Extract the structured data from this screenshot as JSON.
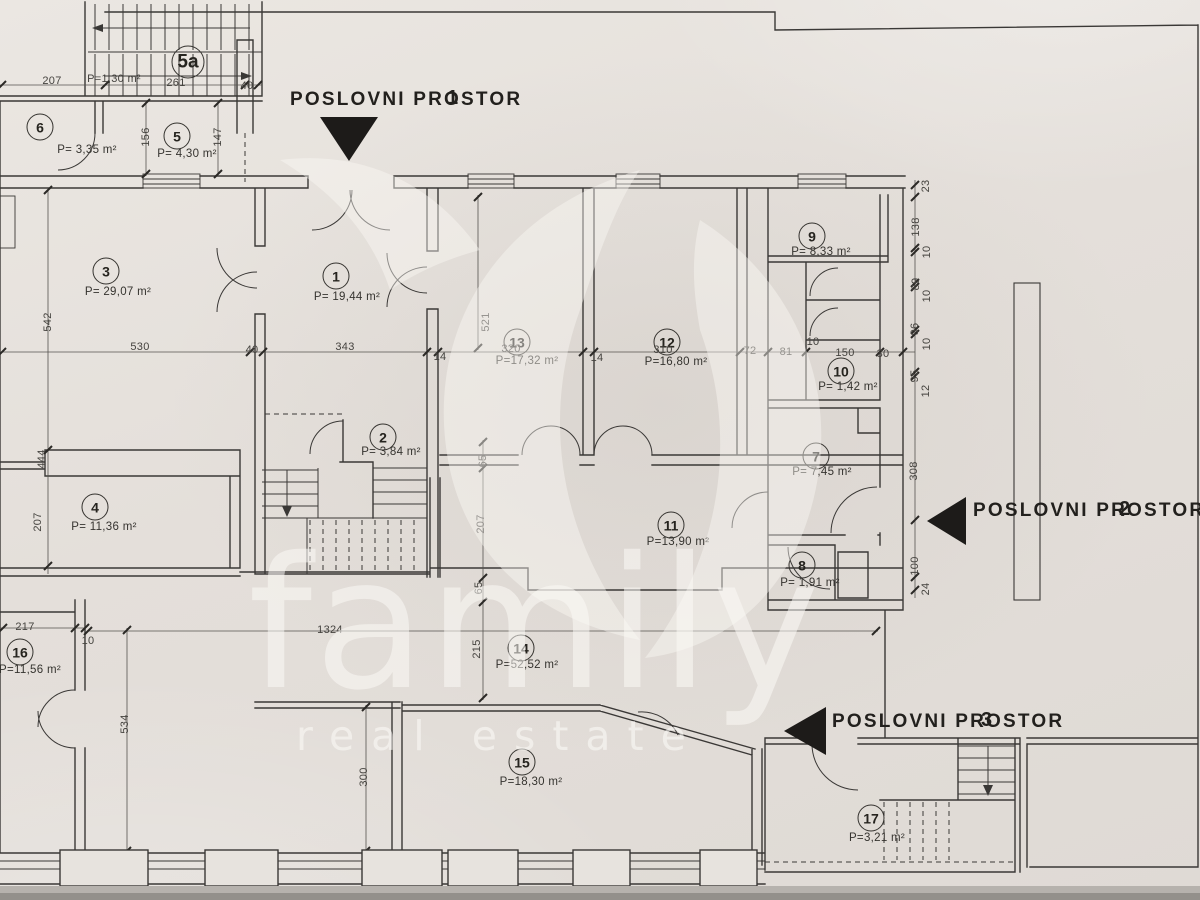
{
  "colors": {
    "line": "#3a3836",
    "dim_line": "#55534f",
    "arrow_fill": "#1d1b19",
    "paper": "#e7e3de"
  },
  "watermark": {
    "brand": "family",
    "tagline": "real estate"
  },
  "annotations": [
    {
      "text": "POSLOVNI PROSTOR",
      "digit": "1",
      "x": 290,
      "y": 89,
      "digit_dx": 157,
      "arrow": "down"
    },
    {
      "text": "POSLOVNI PROSTOR",
      "digit": "2",
      "x": 973,
      "y": 500,
      "digit_dx": 146,
      "arrow": "left"
    },
    {
      "text": "POSLOVNI PROSTOR",
      "digit": "3",
      "x": 832,
      "y": 711,
      "digit_dx": 149,
      "arrow": "left"
    }
  ],
  "rooms": [
    {
      "num": "5a",
      "area": "",
      "cx": 188,
      "cy": 62,
      "big": true
    },
    {
      "num": "6",
      "area": "P= 3,35 m²",
      "cx": 40,
      "cy": 127,
      "ax": 87,
      "ay": 150
    },
    {
      "num": "5",
      "area": "P= 4,30 m²",
      "cx": 177,
      "cy": 136,
      "ax": 187,
      "ay": 154
    },
    {
      "num": "3",
      "area": "P= 29,07 m²",
      "cx": 106,
      "cy": 271,
      "ax": 118,
      "ay": 292
    },
    {
      "num": "1",
      "area": "P= 19,44 m²",
      "cx": 336,
      "cy": 276,
      "ax": 347,
      "ay": 297
    },
    {
      "num": "13",
      "area": "P=17,32 m²",
      "cx": 517,
      "cy": 342,
      "ax": 527,
      "ay": 361
    },
    {
      "num": "12",
      "area": "P=16,80 m²",
      "cx": 667,
      "cy": 342,
      "ax": 676,
      "ay": 362
    },
    {
      "num": "9",
      "area": "P= 8,33 m²",
      "cx": 812,
      "cy": 236,
      "ax": 821,
      "ay": 252
    },
    {
      "num": "10",
      "area": "P= 1,42 m²",
      "cx": 841,
      "cy": 371,
      "ax": 848,
      "ay": 387
    },
    {
      "num": "7",
      "area": "P= 7,45 m²",
      "cx": 816,
      "cy": 456,
      "ax": 822,
      "ay": 472
    },
    {
      "num": "8",
      "area": "P= 1,91 m²",
      "cx": 802,
      "cy": 565,
      "ax": 810,
      "ay": 583
    },
    {
      "num": "2",
      "area": "P= 3,84 m²",
      "cx": 383,
      "cy": 437,
      "ax": 391,
      "ay": 452
    },
    {
      "num": "4",
      "area": "P= 11,36 m²",
      "cx": 95,
      "cy": 507,
      "ax": 104,
      "ay": 527
    },
    {
      "num": "11",
      "area": "P=13,90 m²",
      "cx": 671,
      "cy": 525,
      "ax": 678,
      "ay": 542
    },
    {
      "num": "16",
      "area": "P=11,56 m²",
      "cx": 20,
      "cy": 652,
      "ax": 30,
      "ay": 670
    },
    {
      "num": "14",
      "area": "P=52,52 m²",
      "cx": 521,
      "cy": 648,
      "ax": 527,
      "ay": 665
    },
    {
      "num": "15",
      "area": "P=18,30 m²",
      "cx": 522,
      "cy": 762,
      "ax": 531,
      "ay": 782
    },
    {
      "num": "17",
      "area": "P=3,21 m²",
      "cx": 871,
      "cy": 818,
      "ax": 877,
      "ay": 838
    }
  ],
  "dimensions": [
    {
      "t": "207",
      "x": 52,
      "y": 81
    },
    {
      "t": "261",
      "x": 176,
      "y": 83
    },
    {
      "t": "40",
      "x": 247,
      "y": 86
    },
    {
      "t": "P=1,30 m²",
      "x": 114,
      "y": 79
    },
    {
      "t": "156",
      "x": 146,
      "y": 137,
      "r": 1
    },
    {
      "t": "147",
      "x": 218,
      "y": 137,
      "r": 1
    },
    {
      "t": "542",
      "x": 48,
      "y": 322,
      "r": 1
    },
    {
      "t": "530",
      "x": 140,
      "y": 347
    },
    {
      "t": "40",
      "x": 252,
      "y": 350
    },
    {
      "t": "343",
      "x": 345,
      "y": 347
    },
    {
      "t": "14",
      "x": 440,
      "y": 357
    },
    {
      "t": "521",
      "x": 486,
      "y": 322,
      "r": 1
    },
    {
      "t": "320",
      "x": 511,
      "y": 349
    },
    {
      "t": "14",
      "x": 597,
      "y": 358
    },
    {
      "t": "310",
      "x": 663,
      "y": 350
    },
    {
      "t": "72",
      "x": 750,
      "y": 351
    },
    {
      "t": "81",
      "x": 786,
      "y": 352
    },
    {
      "t": "10",
      "x": 813,
      "y": 342
    },
    {
      "t": "150",
      "x": 845,
      "y": 353
    },
    {
      "t": "30",
      "x": 883,
      "y": 354
    },
    {
      "t": "23",
      "x": 926,
      "y": 186,
      "r": 1
    },
    {
      "t": "138",
      "x": 916,
      "y": 227,
      "r": 1
    },
    {
      "t": "10",
      "x": 927,
      "y": 252,
      "r": 1
    },
    {
      "t": "89",
      "x": 916,
      "y": 284,
      "r": 1
    },
    {
      "t": "10",
      "x": 927,
      "y": 296,
      "r": 1
    },
    {
      "t": "96",
      "x": 915,
      "y": 329,
      "r": 1
    },
    {
      "t": "10",
      "x": 927,
      "y": 344,
      "r": 1
    },
    {
      "t": "95",
      "x": 915,
      "y": 376,
      "r": 1
    },
    {
      "t": "12",
      "x": 926,
      "y": 391,
      "r": 1
    },
    {
      "t": "308",
      "x": 914,
      "y": 471,
      "r": 1
    },
    {
      "t": "100",
      "x": 915,
      "y": 566,
      "r": 1
    },
    {
      "t": "24",
      "x": 926,
      "y": 589,
      "r": 1
    },
    {
      "t": "65",
      "x": 483,
      "y": 461,
      "r": 1
    },
    {
      "t": "207",
      "x": 481,
      "y": 524,
      "r": 1
    },
    {
      "t": "65",
      "x": 479,
      "y": 588,
      "r": 1
    },
    {
      "t": "215",
      "x": 477,
      "y": 649,
      "r": 1
    },
    {
      "t": "444",
      "x": 42,
      "y": 459,
      "r": 1
    },
    {
      "t": "207",
      "x": 38,
      "y": 522,
      "r": 1
    },
    {
      "t": "217",
      "x": 25,
      "y": 627
    },
    {
      "t": "10",
      "x": 88,
      "y": 641
    },
    {
      "t": "534",
      "x": 125,
      "y": 724,
      "r": 1
    },
    {
      "t": "1324",
      "x": 330,
      "y": 630
    },
    {
      "t": "300",
      "x": 364,
      "y": 777,
      "r": 1
    }
  ]
}
